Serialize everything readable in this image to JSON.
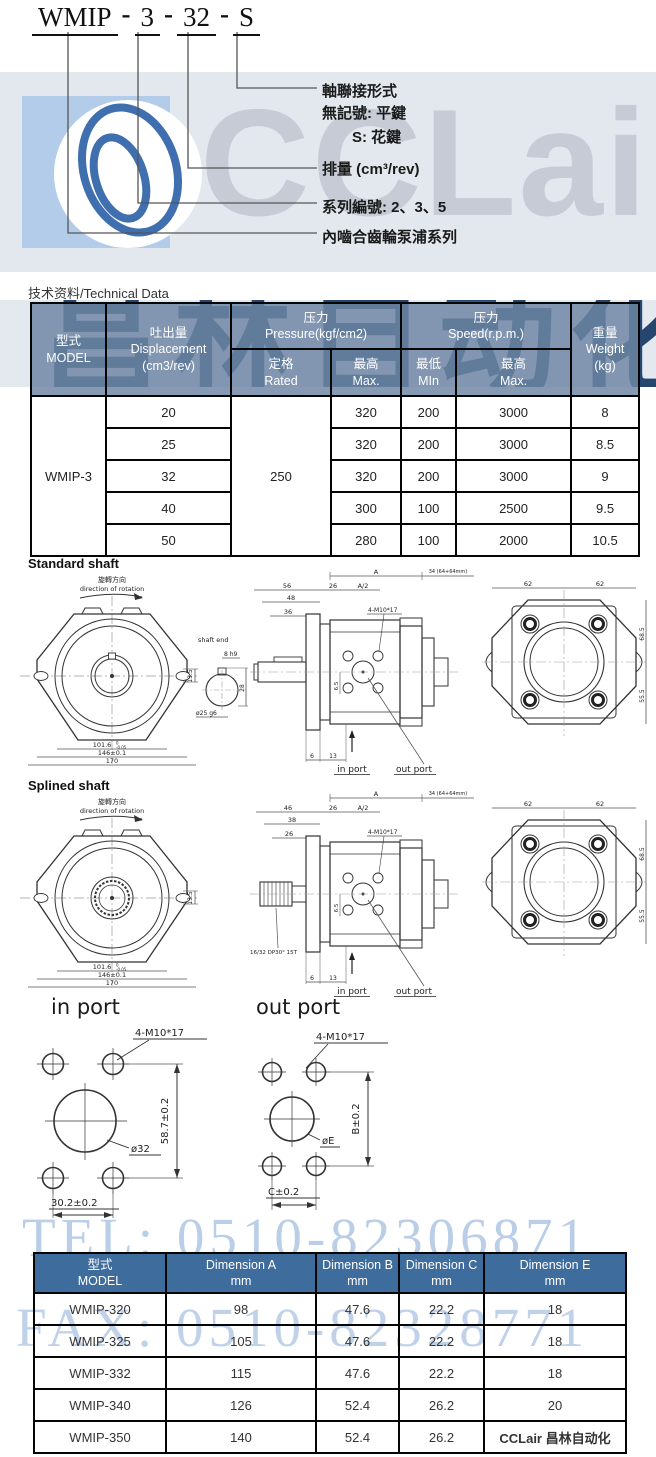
{
  "title": {
    "seg1": "WMIP",
    "seg2": "3",
    "seg3": "32",
    "seg4": "S",
    "sep": "-"
  },
  "code_labels": {
    "shaft_type": "軸聯接形式",
    "flat_key": "無記號: 平鍵",
    "spline_key": "S: 花鍵",
    "displacement": "排量 (cm³/rev)",
    "series_no": "系列編號: 2、3、5",
    "series_name": "內嚙合齒輪泵浦系列"
  },
  "watermark": {
    "brand": "CCLair",
    "brand_dark": "昌林自动化",
    "tel": "TEL: 0510-82306871",
    "fax": "FAX: 0510-82328771",
    "footer_brand": "CCLair 昌林自动化"
  },
  "tech_table": {
    "title": "技术资料/Technical Data",
    "h_model_zh": "型式",
    "h_model_en": "MODEL",
    "h_disp_zh": "吐出量",
    "h_disp_en": "Displacement",
    "h_disp_unit": "(cm3/rev)",
    "h_press_zh": "压力",
    "h_press_en": "Pressure(kgf/cm2)",
    "h_speed_zh": "压力",
    "h_speed_en": "Speed(r.p.m.)",
    "h_weight_zh": "重量",
    "h_weight_en": "Weight",
    "h_weight_unit": "(kg)",
    "h_rated_zh": "定格",
    "h_rated_en": "Rated",
    "h_max_zh": "最高",
    "h_max_en": "Max.",
    "h_min_zh": "最低",
    "h_min_en": "MIn",
    "h_max2_zh": "最高",
    "h_max2_en": "Max.",
    "model": "WMIP-3",
    "rated": "250",
    "rows": [
      {
        "disp": "20",
        "pmax": "320",
        "smin": "200",
        "smax": "3000",
        "wt": "8"
      },
      {
        "disp": "25",
        "pmax": "320",
        "smin": "200",
        "smax": "3000",
        "wt": "8.5"
      },
      {
        "disp": "32",
        "pmax": "320",
        "smin": "200",
        "smax": "3000",
        "wt": "9"
      },
      {
        "disp": "40",
        "pmax": "300",
        "smin": "100",
        "smax": "2500",
        "wt": "9.5"
      },
      {
        "disp": "50",
        "pmax": "280",
        "smin": "100",
        "smax": "2000",
        "wt": "10.5"
      }
    ]
  },
  "drawings": {
    "standard": {
      "title": "Standard shaft",
      "rot_zh": "旋轉方向",
      "rot_en": "direction of rotation",
      "d135": "13.5",
      "d1016": "101.6",
      "tol_top": "0",
      "tol_bot": "-0.05",
      "d146": "146±0.1",
      "d170": "170",
      "shaft_end": "shaft end",
      "d8h9": "8 h9",
      "d25g6": "ø25 g6",
      "d28": "28",
      "d56": "56",
      "d48": "48",
      "d36": "36",
      "d26": "26",
      "dA2": "A/2",
      "dA": "A",
      "d34": "34 (64+64mm)",
      "bolt": "4-M10*17",
      "d65": "6.5",
      "d6": "6",
      "d13": "13",
      "in_port": "in port",
      "out_port": "out port",
      "d62a": "62",
      "d62b": "62",
      "d685": "68.5",
      "d555": "55.5"
    },
    "splined": {
      "title": "Splined shaft",
      "rot_zh": "旋轉方向",
      "rot_en": "direction of rotation",
      "d135": "13.5",
      "d1016": "101.6",
      "tol_top": "0",
      "tol_bot": "-0.05",
      "d146": "146±0.1",
      "d170": "170",
      "spline_spec": "16/32 DP30° 15T",
      "d46": "46",
      "d38": "38",
      "d26a": "26",
      "d26b": "26",
      "dA2": "A/2",
      "dA": "A",
      "d34": "34 (64+64mm)",
      "bolt": "4-M10*17",
      "d65": "6.5",
      "d6": "6",
      "d13": "13",
      "in_port": "in port",
      "out_port": "out port",
      "d62a": "62",
      "d62b": "62",
      "d685": "68.5",
      "d555": "55.5"
    },
    "ports": {
      "in_title": "in port",
      "out_title": "out port",
      "bolt": "4-M10*17",
      "in_dia": "ø32",
      "in_v": "58.7±0.2",
      "in_h": "30.2±0.2",
      "out_dia": "øE",
      "out_v": "B±0.2",
      "out_h": "C±0.2"
    }
  },
  "dim_table": {
    "h_model_zh": "型式",
    "h_model_en": "MODEL",
    "h_a1": "Dimension A",
    "h_a2": "mm",
    "h_b1": "Dimension B",
    "h_b2": "mm",
    "h_c1": "Dimension C",
    "h_c2": "mm",
    "h_e1": "Dimension E",
    "h_e2": "mm",
    "rows": [
      {
        "model": "WMIP-320",
        "a": "98",
        "b": "47.6",
        "c": "22.2",
        "e": "18"
      },
      {
        "model": "WMIP-325",
        "a": "105",
        "b": "47.6",
        "c": "22.2",
        "e": "18"
      },
      {
        "model": "WMIP-332",
        "a": "115",
        "b": "47.6",
        "c": "22.2",
        "e": "18"
      },
      {
        "model": "WMIP-340",
        "a": "126",
        "b": "52.4",
        "c": "26.2",
        "e": "20"
      },
      {
        "model": "WMIP-350",
        "a": "140",
        "b": "52.4",
        "c": "26.2",
        "e": ""
      }
    ]
  }
}
